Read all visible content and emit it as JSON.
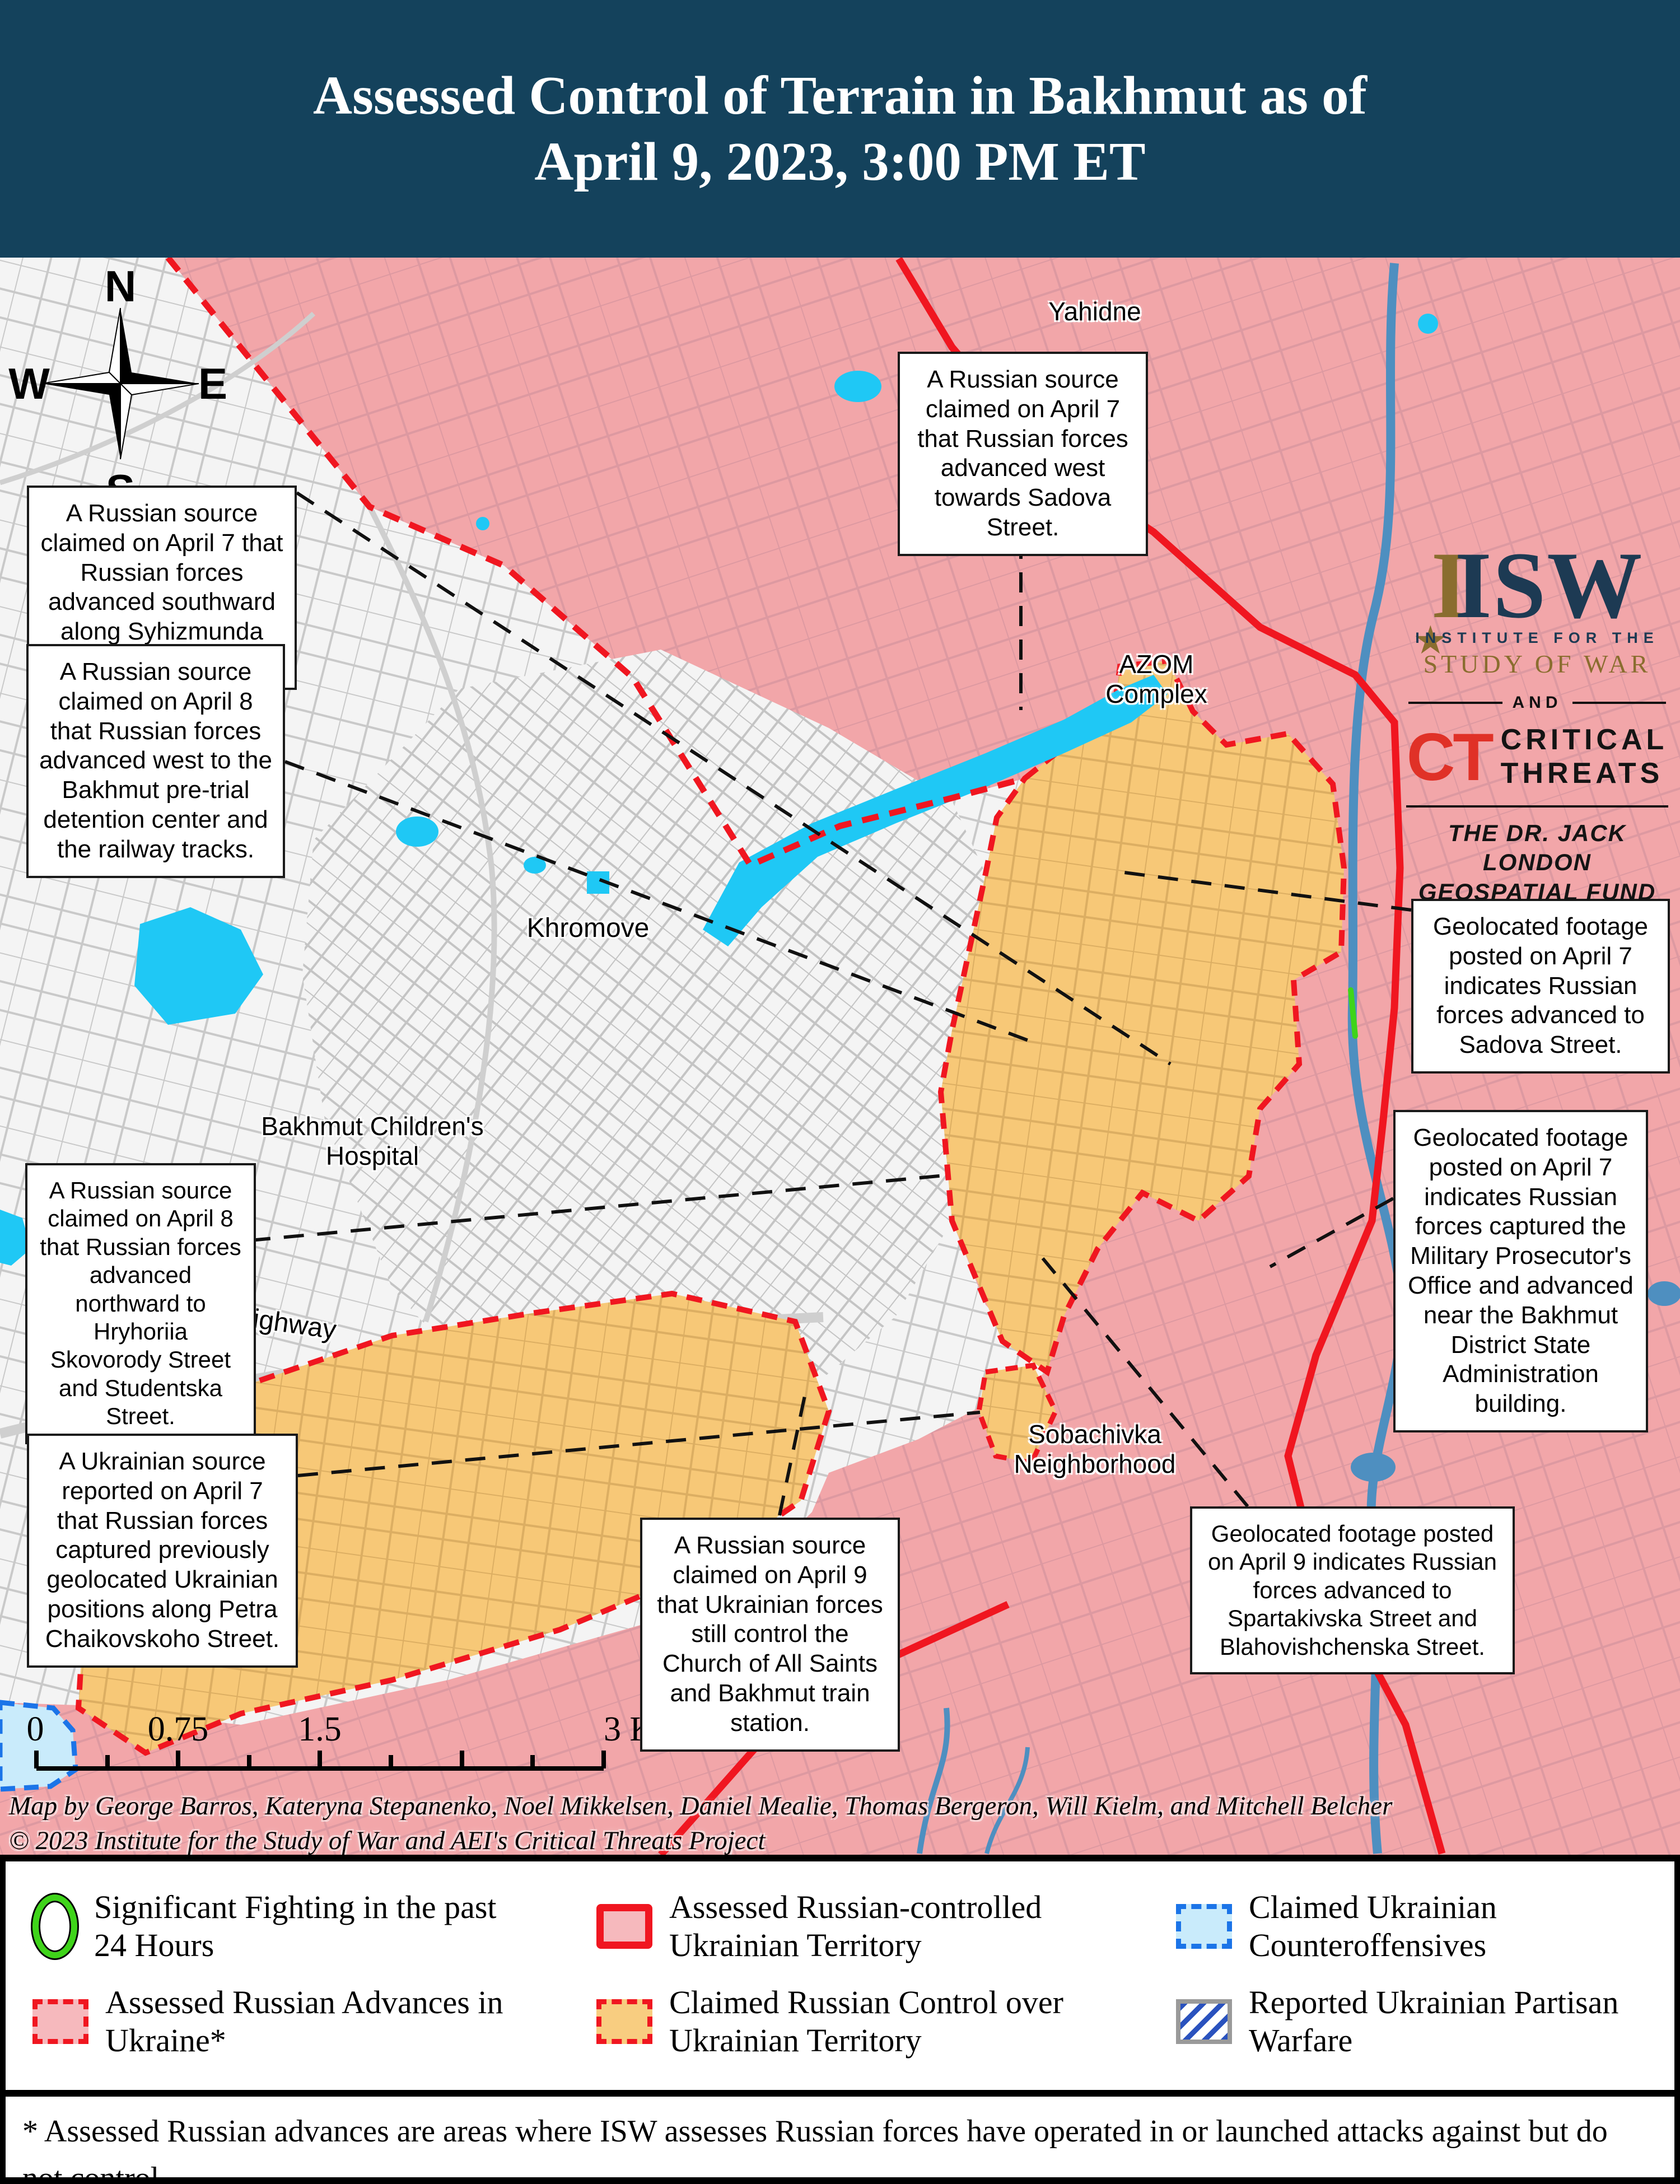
{
  "header": {
    "title_line1": "Assessed Control of Terrain in Bakhmut as of",
    "title_line2": "April 9, 2023, 3:00 PM ET"
  },
  "logo": {
    "isw_i": "I",
    "isw": "ISW",
    "star": "★",
    "institute": "INSTITUTE FOR THE",
    "study_of_war": "STUDY OF WAR",
    "and": "AND",
    "ct": "CT",
    "critical": "CRITICAL",
    "threats": "THREATS",
    "fund_line1": "THE DR. JACK LONDON",
    "fund_line2": "GEOSPATIAL FUND"
  },
  "compass": {
    "n": "N",
    "s": "S",
    "e": "E",
    "w": "W"
  },
  "places": {
    "yahidne": "Yahidne",
    "azom_line1": "AZOM",
    "azom_line2": "Complex",
    "khromove": "Khromove",
    "hospital_line1": "Bakhmut Children's",
    "hospital_line2": "Hospital",
    "t0504": "T0504 Highway",
    "sobachivka_line1": "Sobachivka",
    "sobachivka_line2": "Neighborhood"
  },
  "callouts": [
    {
      "text": "A Russian source claimed on April 7 that Russian forces advanced southward along Syhizmunda Levanevskoho Street."
    },
    {
      "text": "A Russian source claimed on April 8 that Russian forces advanced west to the Bakhmut pre-trial detention center and the railway tracks."
    },
    {
      "text": "A Russian source claimed on April 7 that Russian forces advanced west towards Sadova Street."
    },
    {
      "text": "Geolocated footage posted on April 7 indicates Russian forces advanced to Sadova Street."
    },
    {
      "text": "Geolocated footage posted on April 7 indicates Russian forces captured the Military Prosecutor's Office and advanced near the Bakhmut District State Administration building."
    },
    {
      "text": "A Russian source claimed on April 8 that Russian forces advanced northward to Hryhoriia Skovorody Street and Studentska Street."
    },
    {
      "text": "A Ukrainian source reported on April 7 that Russian forces captured previously geolocated Ukrainian positions along Petra Chaikovskoho Street."
    },
    {
      "text": "A Russian source claimed on April 9 that Ukrainian forces still control the Church of All Saints and Bakhmut train station."
    },
    {
      "text": "Geolocated footage posted on April 9 indicates Russian forces advanced to Spartakivska Street and Blahovishchenska Street."
    }
  ],
  "scalebar": {
    "tick0": "0",
    "tick1": "0.75",
    "tick2": "1.5",
    "tick3": "3 Kilometers"
  },
  "attribution": {
    "line1": "Map by George Barros, Kateryna Stepanenko, Noel Mikkelsen, Daniel Mealie, Thomas Bergeron, Will Kielm, and Mitchell Belcher",
    "line2": "© 2023 Institute for the Study of War and AEI's Critical Threats Project"
  },
  "legend": {
    "items": [
      {
        "label": "Significant Fighting in the past 24 Hours"
      },
      {
        "label": "Assessed Russian-controlled Ukrainian Territory"
      },
      {
        "label": "Claimed Ukrainian Counteroffensives"
      },
      {
        "label": "Assessed Russian Advances in Ukraine*"
      },
      {
        "label": "Claimed Russian Control over Ukrainian Territory"
      },
      {
        "label": "Reported Ukrainian Partisan Warfare"
      }
    ]
  },
  "footnote": "* Assessed Russian advances are areas where ISW assesses Russian forces have operated in or launched attacks against but do not control.",
  "colors": {
    "header_bg": "#14425C",
    "russian_controlled_fill": "#F2A6A9",
    "claimed_russian_fill": "#F7C877",
    "counteroffensive_fill": "#C9EBFB",
    "counteroffensive_border": "#1B74E8",
    "red_line": "#F01620",
    "water": "#1FC8F5",
    "river": "#4E8FC0",
    "fighting_green": "#3FD41A",
    "partisan_blue": "#2A52BE"
  }
}
